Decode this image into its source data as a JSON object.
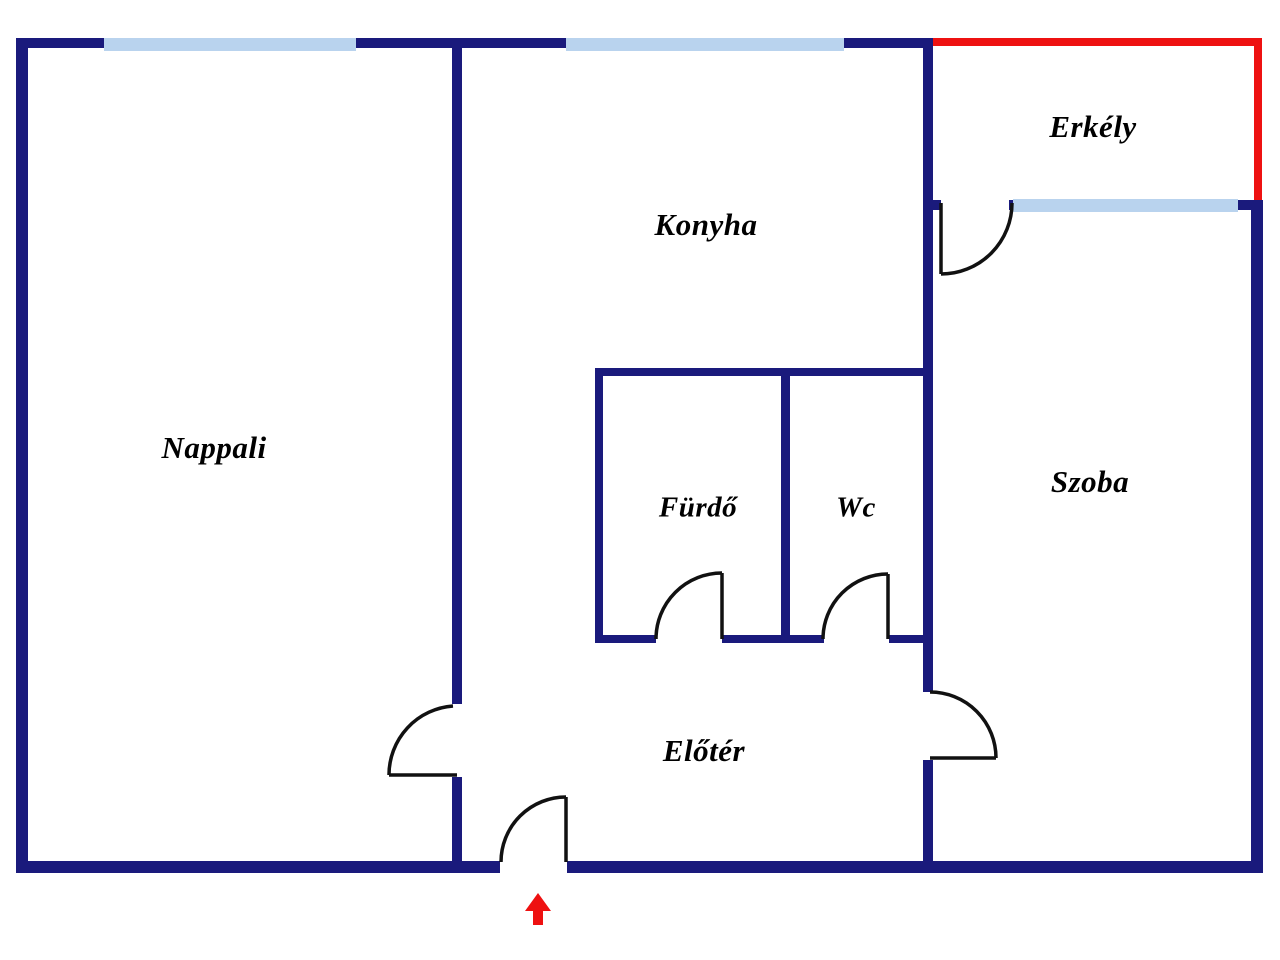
{
  "title": "Apartment floor plan",
  "colors": {
    "background": "#ffffff",
    "wall": "#1a1a7c",
    "window": "#b9d3ee",
    "balcony": "#ee1111",
    "door": "#111111",
    "label": "#000000"
  },
  "rooms": {
    "nappali": {
      "label": "Nappali"
    },
    "konyha": {
      "label": "Konyha"
    },
    "erkely": {
      "label": "Erkély"
    },
    "furdo": {
      "label": "Fürdő"
    },
    "wc": {
      "label": "Wc"
    },
    "szoba": {
      "label": "Szoba"
    },
    "eloter": {
      "label": "Előtér"
    }
  },
  "markers": {
    "entrance_arrow": "red-up-arrow"
  }
}
